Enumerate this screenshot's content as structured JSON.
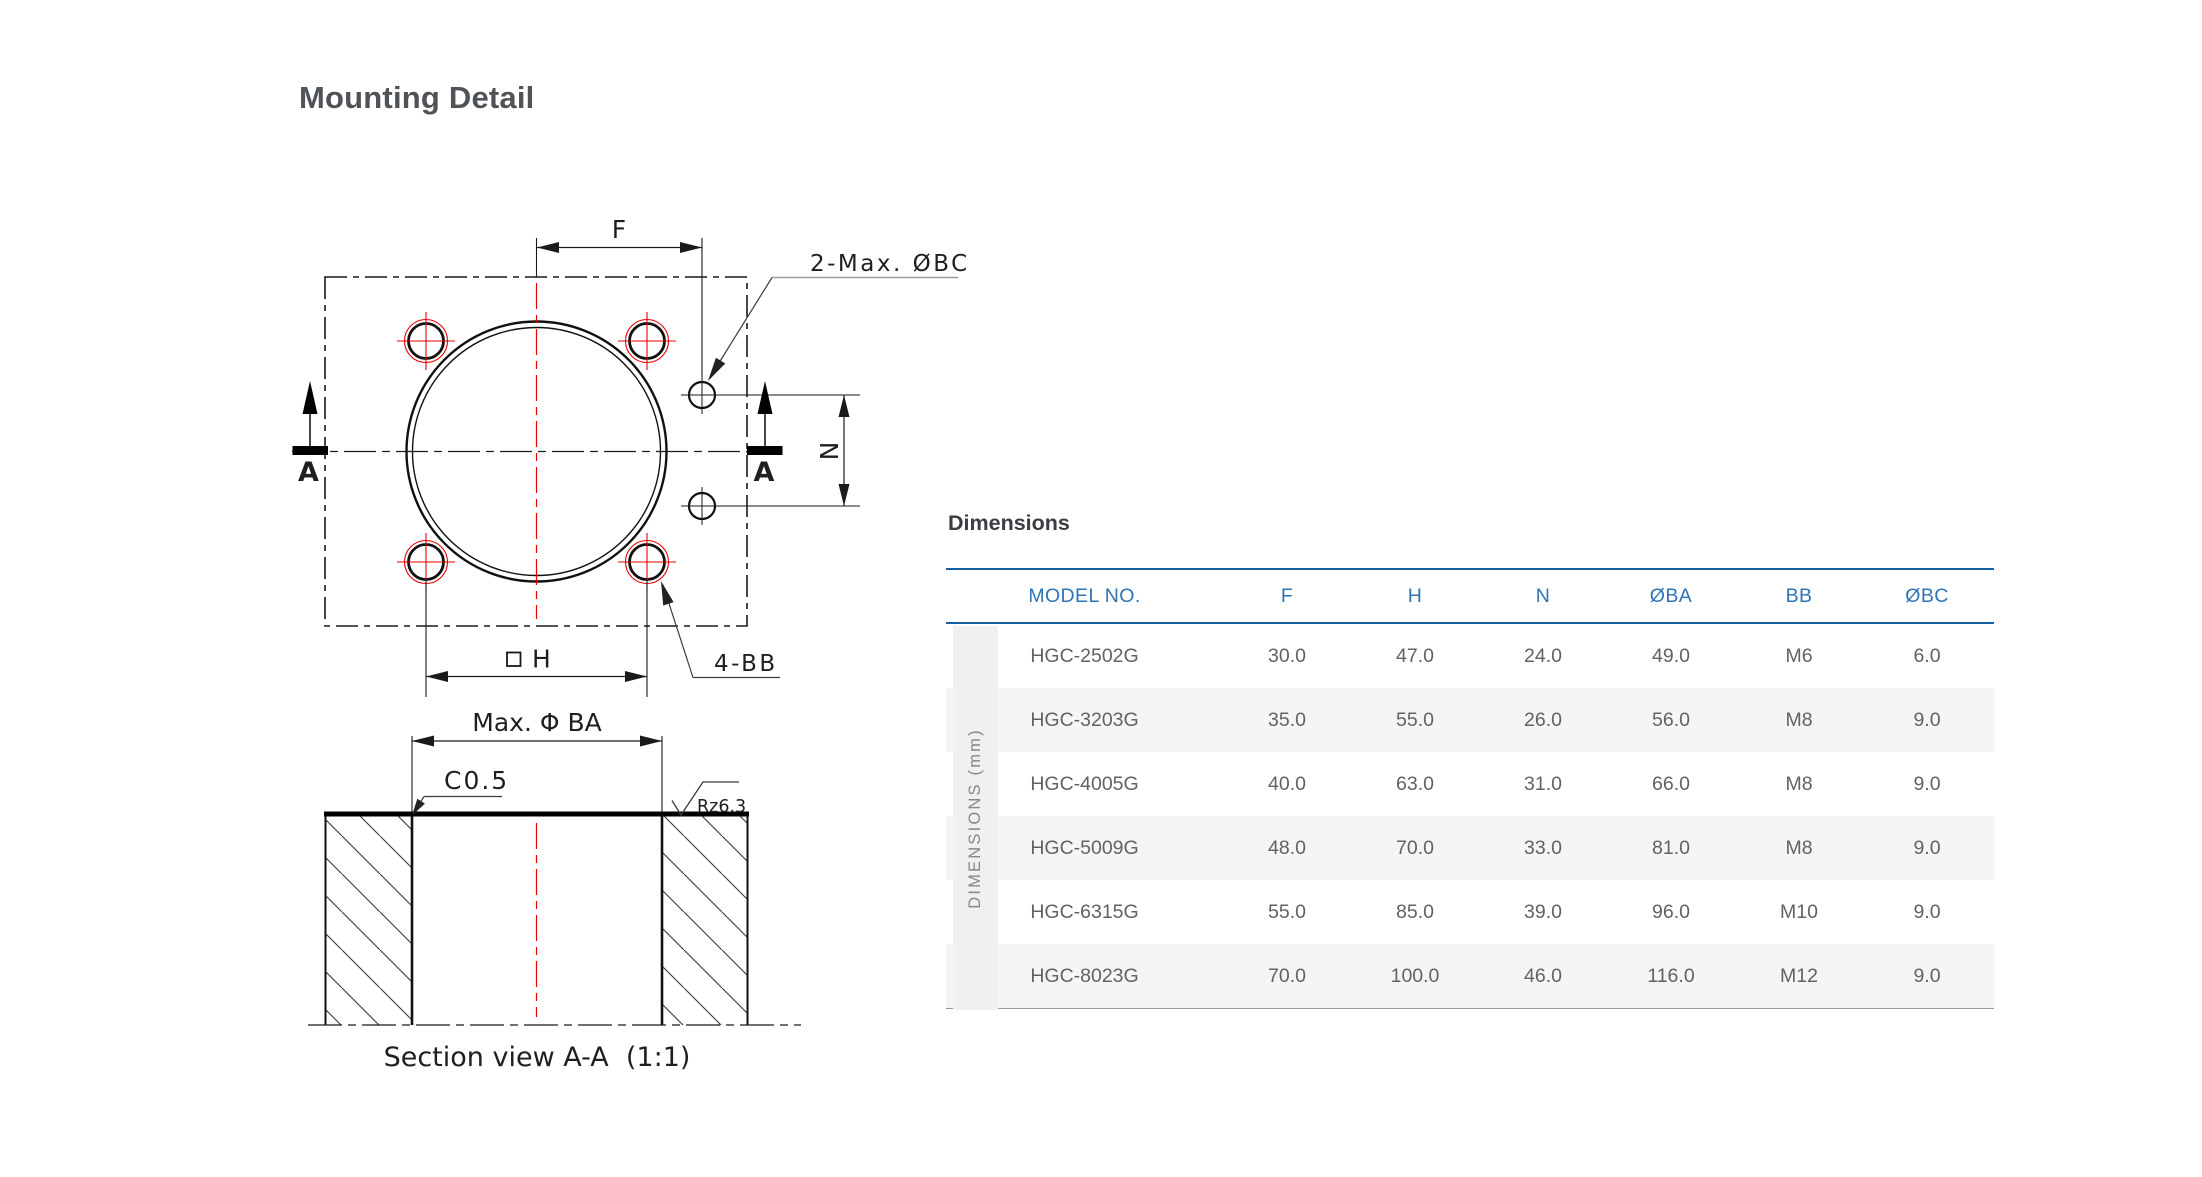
{
  "page": {
    "title": "Mounting Detail"
  },
  "drawing": {
    "dim_f": "F",
    "dim_n": "N",
    "dim_h": "H",
    "callout_bc": "2-Max. ØBC",
    "callout_bb": "4-BB",
    "section_marker": "A",
    "dim_ba": "Max. Φ BA",
    "chamfer": "C0.5",
    "roughness": "Rz6.3",
    "section_caption": "Section view A-A  (1:1)"
  },
  "table": {
    "caption": "Dimensions",
    "side_label": "DIMENSIONS (mm)",
    "columns": [
      "MODEL NO.",
      "F",
      "H",
      "N",
      "ØBA",
      "BB",
      "ØBC"
    ],
    "rows": [
      {
        "model": "HGC-2502G",
        "f": "30.0",
        "h": "47.0",
        "n": "24.0",
        "ba": "49.0",
        "bb": "M6",
        "bc": "6.0"
      },
      {
        "model": "HGC-3203G",
        "f": "35.0",
        "h": "55.0",
        "n": "26.0",
        "ba": "56.0",
        "bb": "M8",
        "bc": "9.0"
      },
      {
        "model": "HGC-4005G",
        "f": "40.0",
        "h": "63.0",
        "n": "31.0",
        "ba": "66.0",
        "bb": "M8",
        "bc": "9.0"
      },
      {
        "model": "HGC-5009G",
        "f": "48.0",
        "h": "70.0",
        "n": "33.0",
        "ba": "81.0",
        "bb": "M8",
        "bc": "9.0"
      },
      {
        "model": "HGC-6315G",
        "f": "55.0",
        "h": "85.0",
        "n": "39.0",
        "ba": "96.0",
        "bb": "M10",
        "bc": "9.0"
      },
      {
        "model": "HGC-8023G",
        "f": "70.0",
        "h": "100.0",
        "n": "46.0",
        "ba": "116.0",
        "bb": "M12",
        "bc": "9.0"
      }
    ]
  },
  "colors": {
    "accent_blue_line": "#15619f",
    "header_blue_text": "#2e74b5",
    "centerline_red": "#e60000",
    "row_alt_gray": "#f5f5f6"
  }
}
